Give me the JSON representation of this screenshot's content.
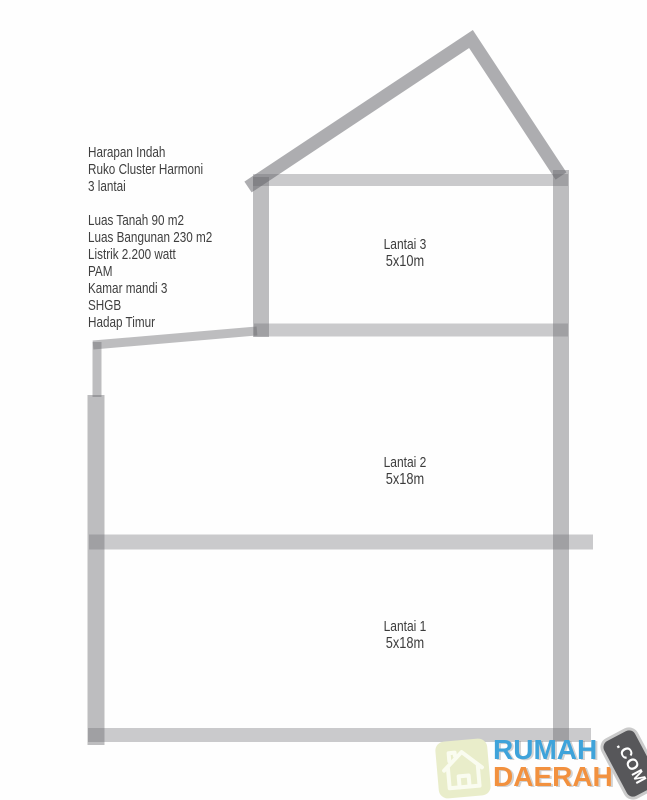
{
  "info": {
    "lines": [
      "Harapan Indah",
      "Ruko Cluster Harmoni",
      "3 lantai",
      "",
      "Luas Tanah 90 m2",
      "Luas Bangunan 230 m2",
      "Listrik 2.200 watt",
      "PAM",
      "Kamar mandi 3",
      "SHGB",
      "Hadap Timur"
    ]
  },
  "diagram": {
    "type": "building-section",
    "stroke_color": "#b5b5b9",
    "floors": [
      {
        "label": "Lantai 3",
        "size": "5x10m"
      },
      {
        "label": "Lantai 2",
        "size": "5x18m"
      },
      {
        "label": "Lantai 1",
        "size": "5x18m"
      }
    ]
  },
  "logo": {
    "word1": "RUMAH",
    "word2": "DAERAH",
    "badge": ".COM",
    "colors": {
      "word1": "#3fa3da",
      "word2": "#f2913f",
      "badge_bg": "#57575a",
      "badge_border": "#cacaca",
      "badge_text": "#ffffff",
      "house_bg": "#e9edca",
      "house_stroke": "#fafcf0"
    }
  }
}
